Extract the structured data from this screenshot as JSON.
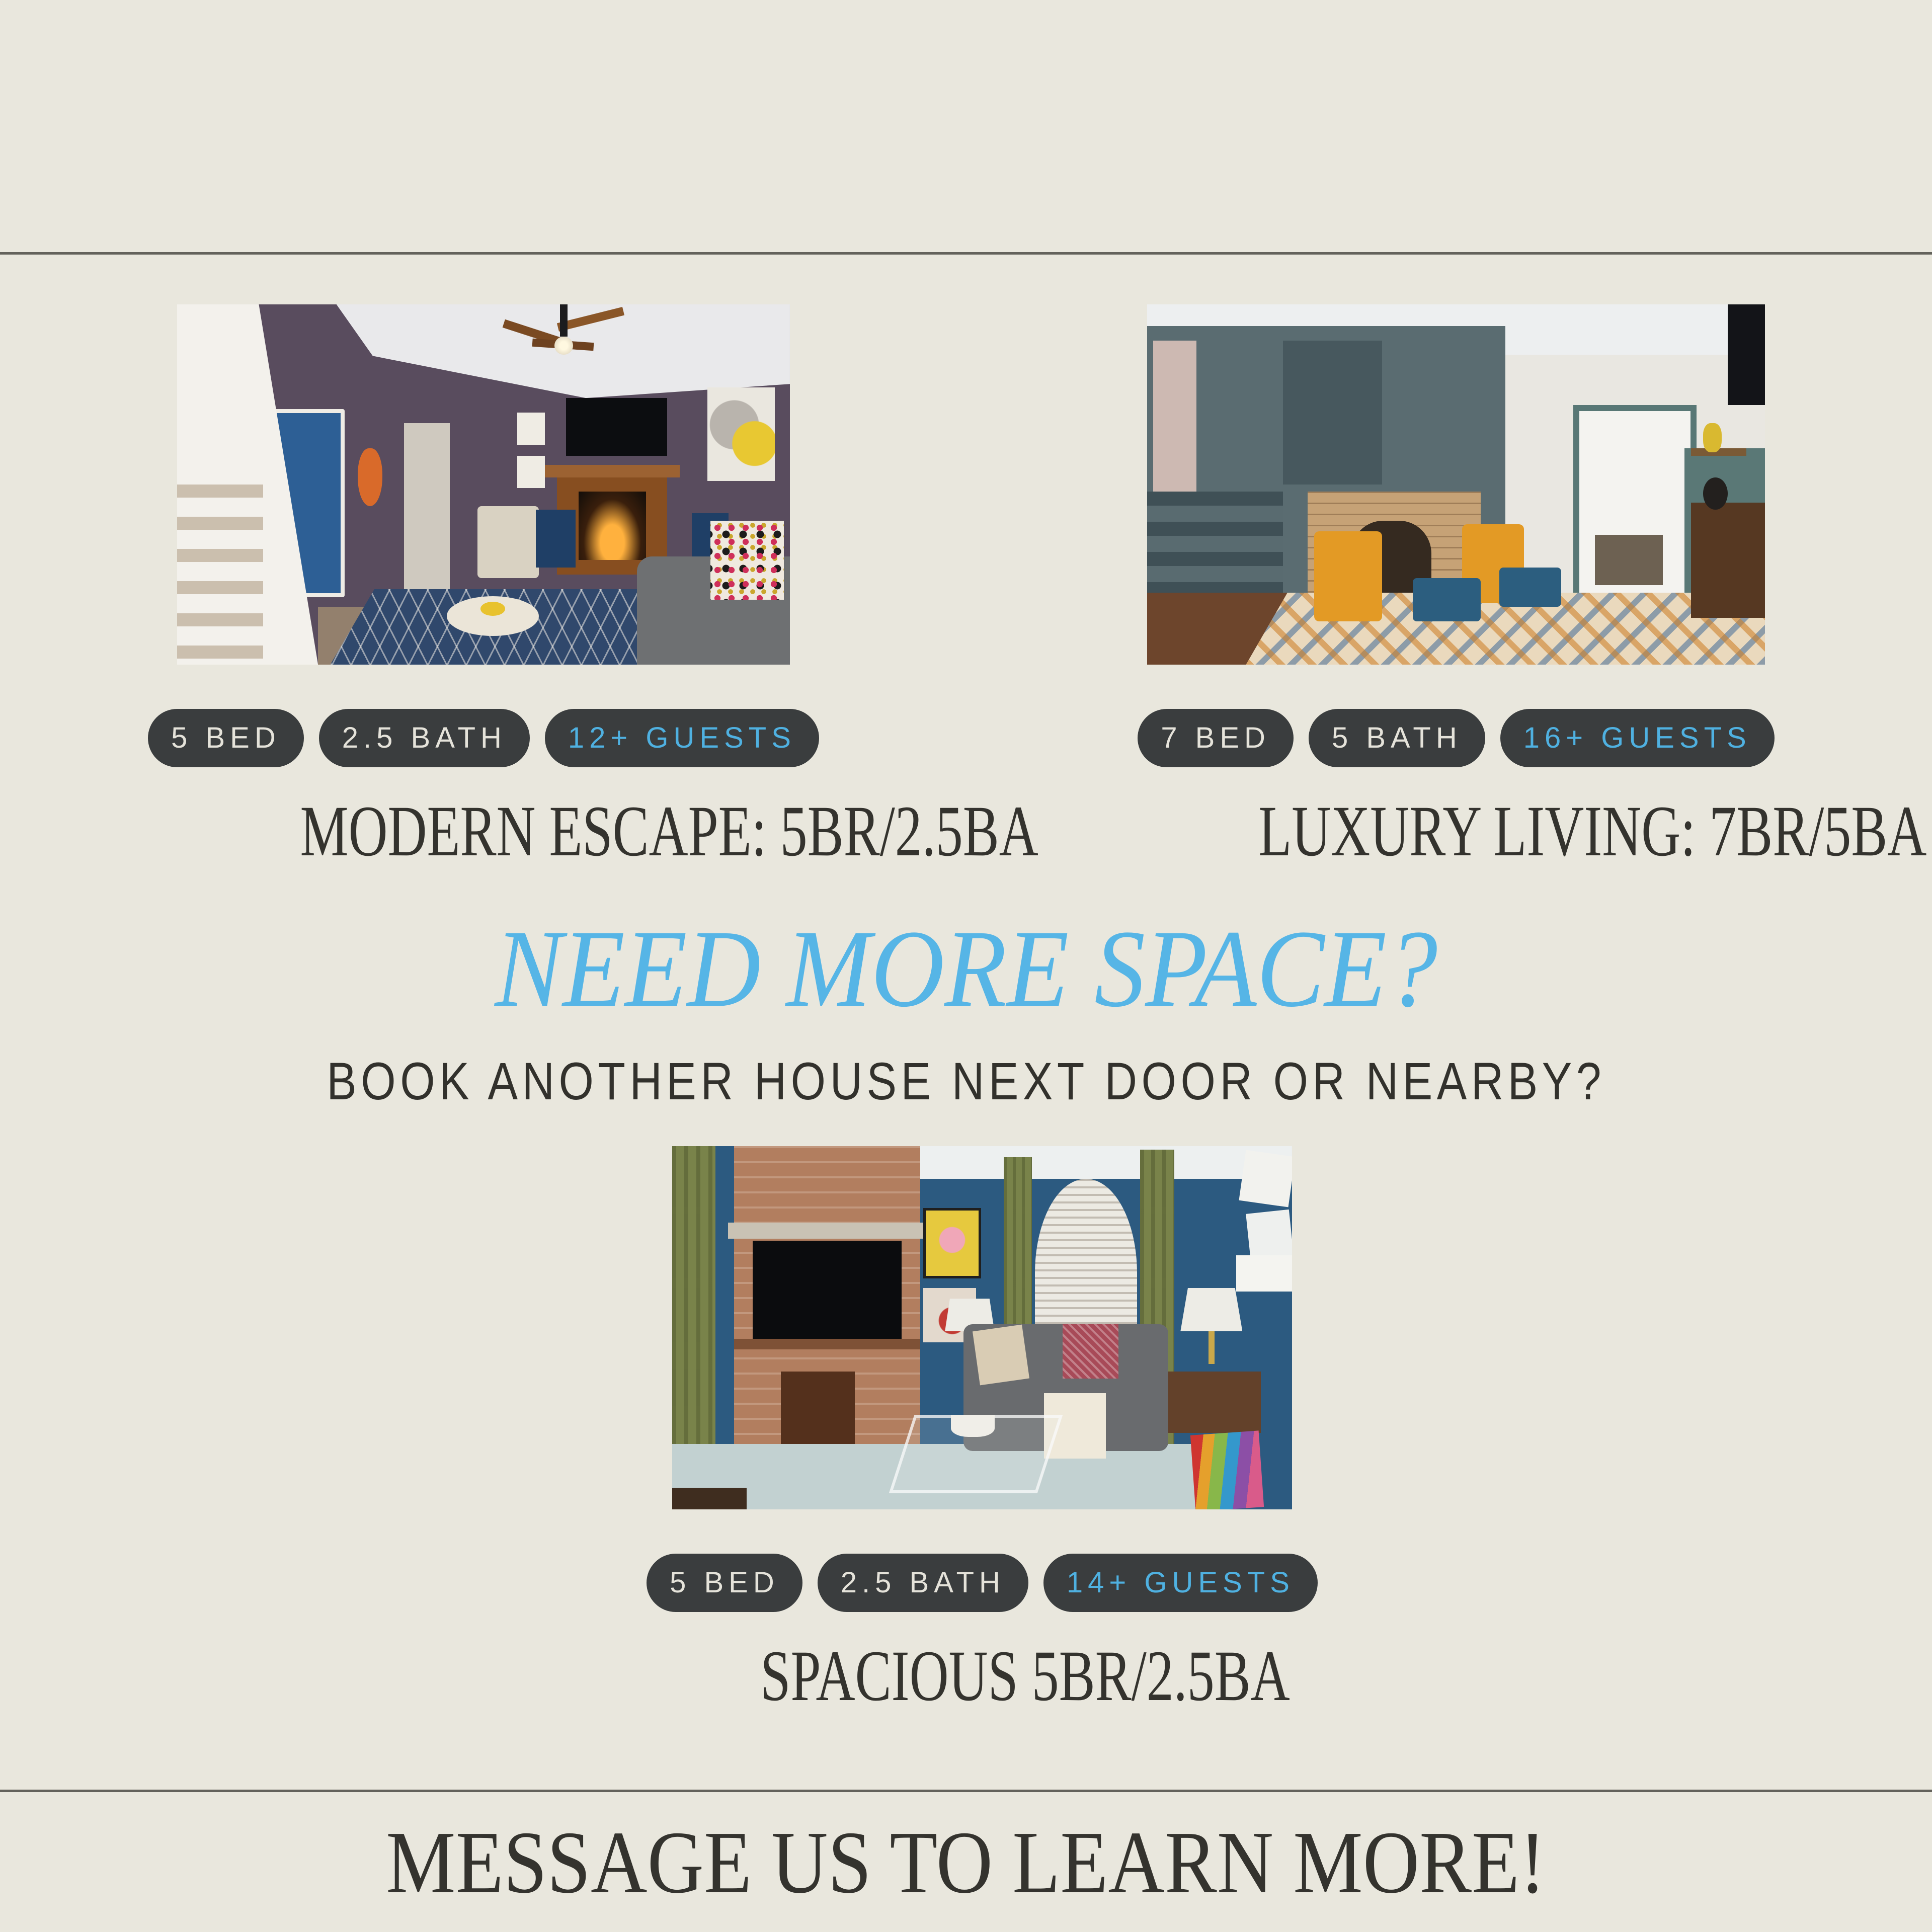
{
  "page": {
    "background_color": "#e9e7dd",
    "divider_color": "#63625b",
    "accent_blue": "#56b5e6",
    "badge_pill_color": "#3a3d3e",
    "badge_text_color": "#e5e3da",
    "badge_highlight_text_color": "#4fb1e1",
    "title_text_color": "#34332e"
  },
  "listings": [
    {
      "name": "modern-escape",
      "photo_alt": "Living room with white staircase, blue front door, dark plum walls, ceiling fan, TV above wood fireplace, navy diamond-pattern rug, gray sofa with colorful dotted pillows",
      "badges": [
        {
          "label": "5 BED"
        },
        {
          "label": "2.5 BATH"
        },
        {
          "label": "12+ GUESTS",
          "highlight": true
        }
      ],
      "title": "MODERN ESCAPE: 5BR/2.5BA"
    },
    {
      "name": "luxury-living",
      "photo_alt": "Sitting room with teal painted woodwork and staircase, brick fireplace, two mustard-yellow chairs with blue ottomans, geometric cream-blue-orange rug, doorway to dining room",
      "badges": [
        {
          "label": "7 BED"
        },
        {
          "label": "5 BATH"
        },
        {
          "label": "16+ GUESTS",
          "highlight": true
        }
      ],
      "title": "LUXURY LIVING: 7BR/5BA"
    },
    {
      "name": "spacious",
      "photo_alt": "Living room with blue walls, brick fireplace with mounted TV, olive green curtains, arched window with blinds, gray sofa, glass coffee table on light blue rug",
      "badges": [
        {
          "label": "5 BED"
        },
        {
          "label": "2.5 BATH"
        },
        {
          "label": "14+ GUESTS",
          "highlight": true
        }
      ],
      "title": "SPACIOUS 5BR/2.5BA"
    }
  ],
  "headline": {
    "text": "NEED MORE SPACE?"
  },
  "subheadline": {
    "text": "BOOK ANOTHER HOUSE NEXT DOOR OR NEARBY?"
  },
  "footer": {
    "text": "MESSAGE US TO LEARN MORE!"
  }
}
